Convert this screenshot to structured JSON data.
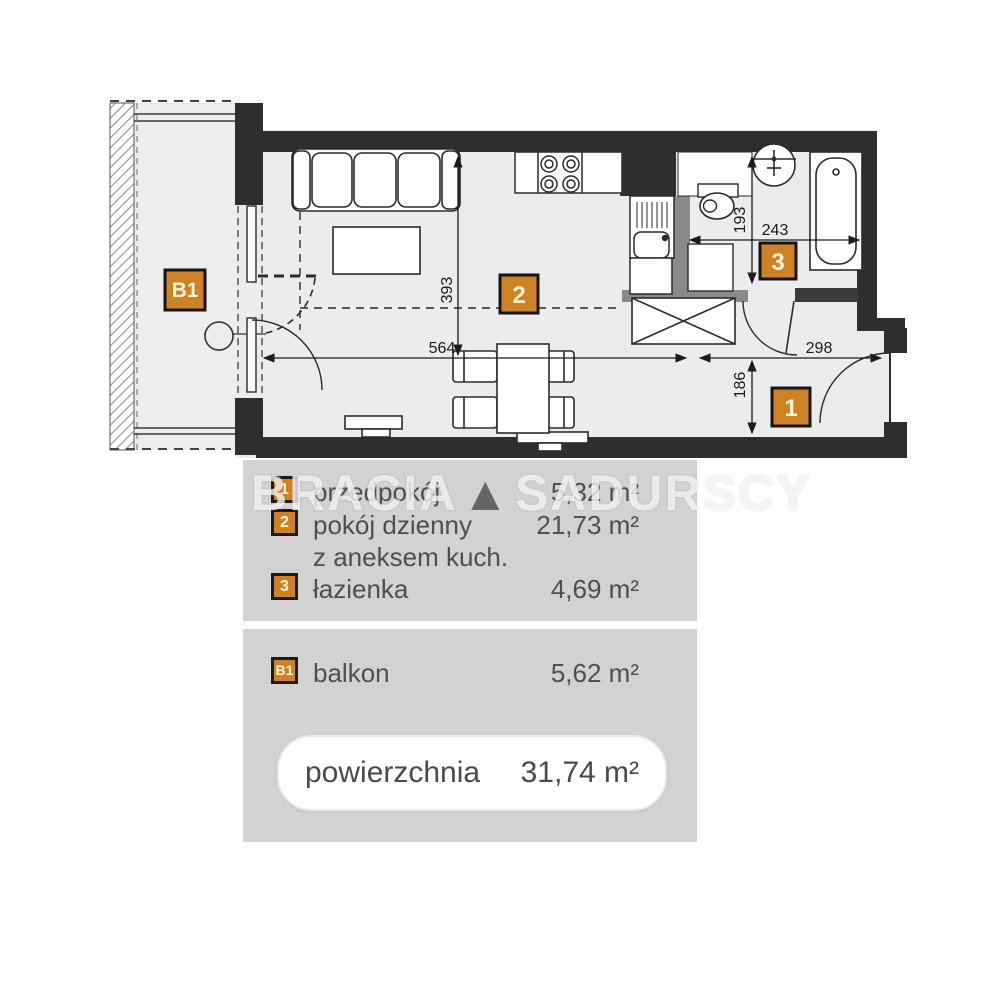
{
  "watermark": {
    "word1": "BRACIA",
    "triangle": "▲",
    "word2": "SADURSCY"
  },
  "floor_plan": {
    "badges": {
      "balcony": "B1",
      "living": "2",
      "bathroom": "3",
      "hall": "1"
    },
    "dimensions": {
      "living_width": "564",
      "living_depth": "393",
      "hall_width": "298",
      "bath_width": "243",
      "bath_depth": "193",
      "hall_depth": "186"
    }
  },
  "legend": {
    "rooms": [
      {
        "badge": "1",
        "label": "przedpokój",
        "area": "5,32 m²"
      },
      {
        "badge": "2",
        "label": "pokój dzienny",
        "label_line2": "z aneksem kuch.",
        "area": "21,73 m²"
      },
      {
        "badge": "3",
        "label": "łazienka",
        "area": "4,69 m²"
      }
    ],
    "balcony_row": {
      "badge": "B1",
      "label": "balkon",
      "area": "5,62 m²"
    },
    "total": {
      "label": "powierzchnia",
      "area": "31,74 m²"
    }
  },
  "colors": {
    "accent_orange": "#ce8226",
    "wall": "#2e2e2e",
    "partition": "#8a8a8a",
    "floor": "#ececec",
    "legend_bg": "#d2d2d2",
    "text": "#4f4f4f"
  }
}
